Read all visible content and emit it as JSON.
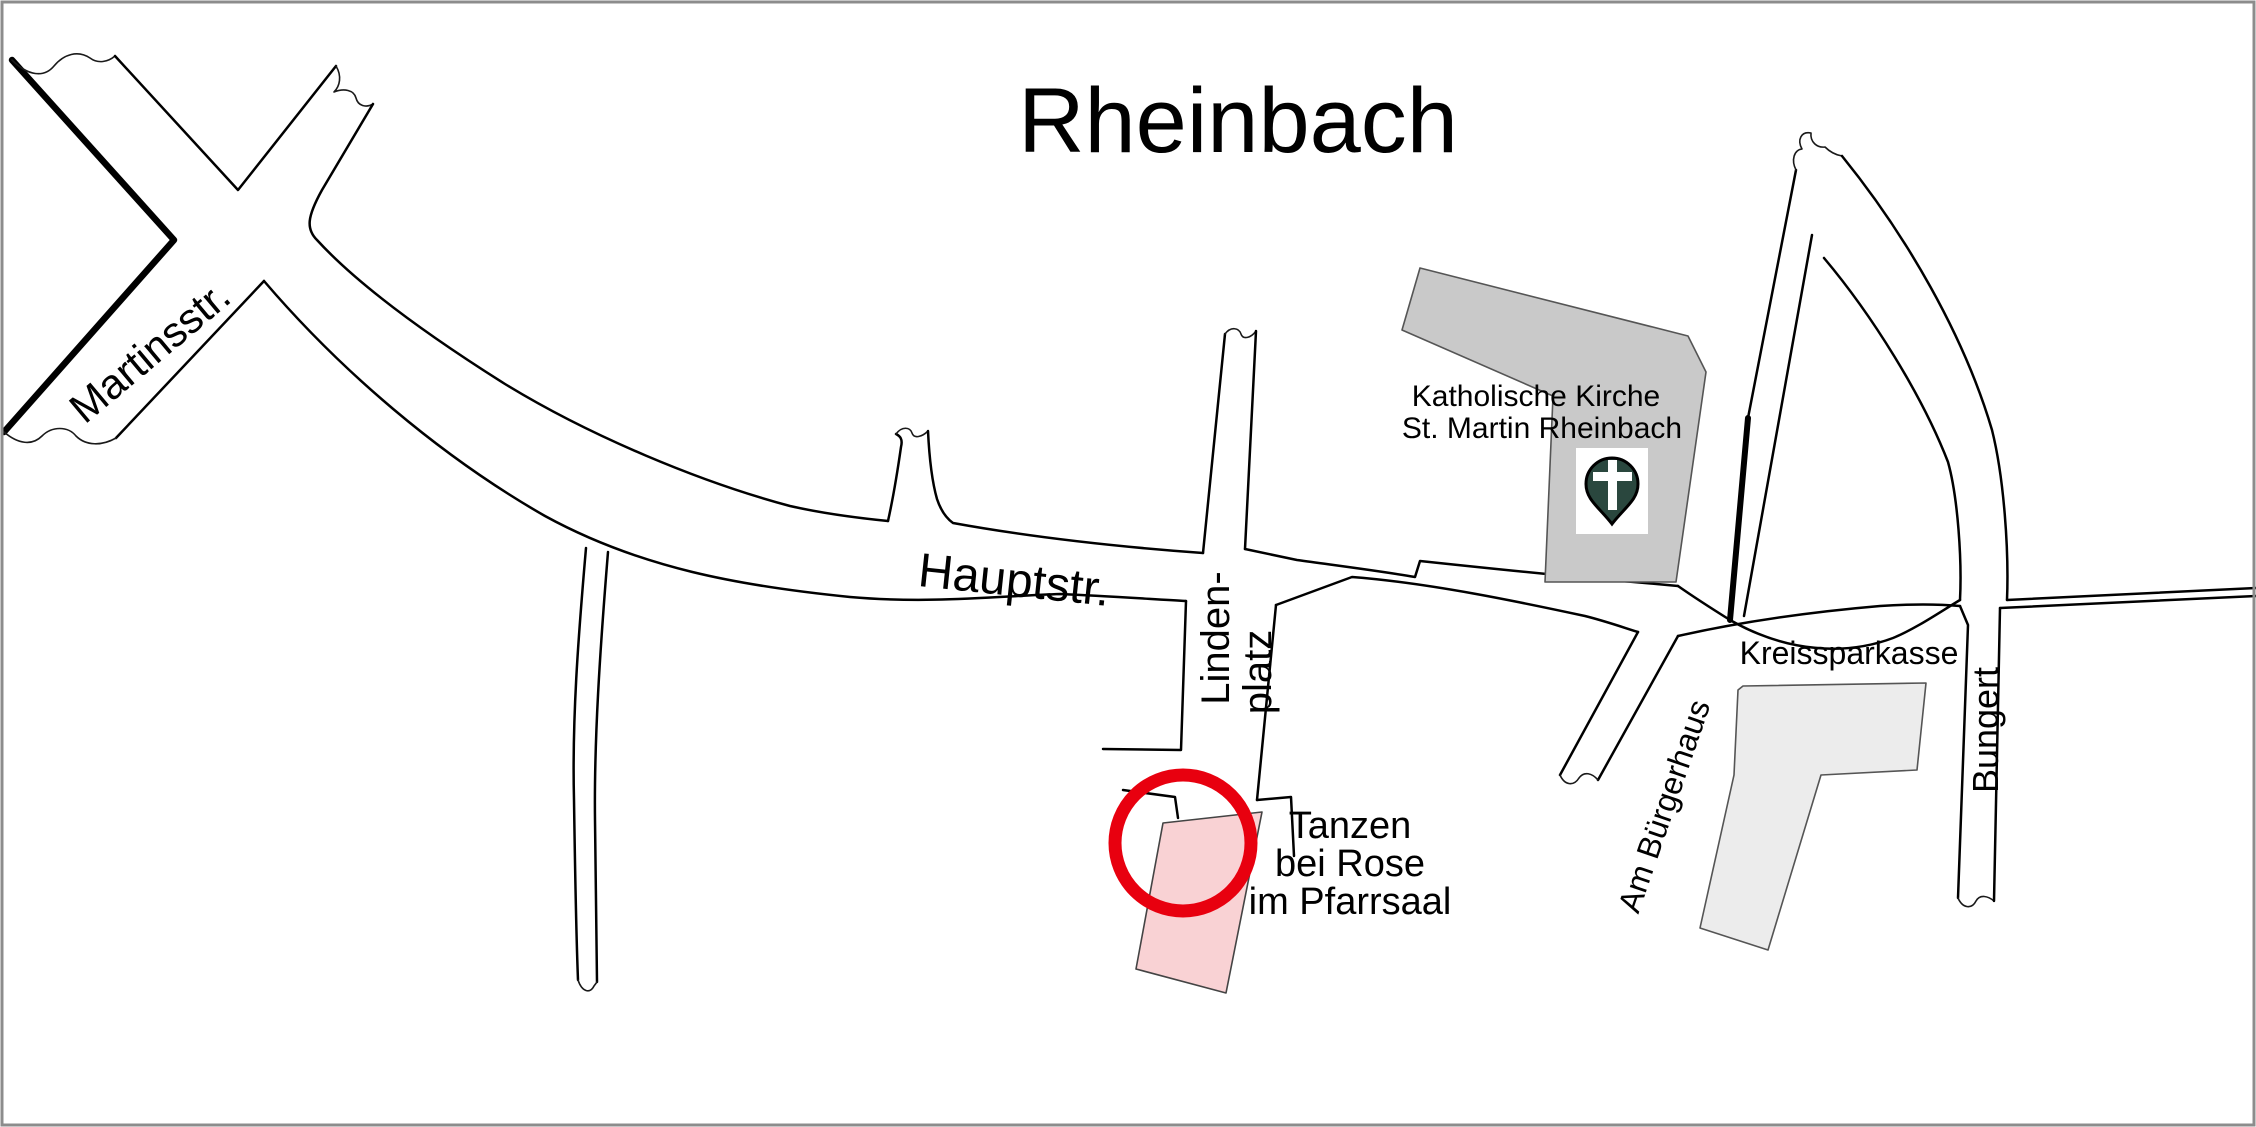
{
  "map": {
    "title": "Rheinbach",
    "streets": {
      "martinsstrasse": "Martinsstr.",
      "hauptstrasse": "Hauptstr.",
      "lindenplatz_line1": "Linden-",
      "lindenplatz_line2": "platz",
      "am_buergerhaus": "Am Bürgerhaus",
      "bungert": "Bungert"
    },
    "places": {
      "church_line1": "Katholische Kirche",
      "church_line2": "St. Martin Rheinbach",
      "bank": "Kreissparkasse"
    },
    "venue": {
      "line1": "Tanzen",
      "line2": "bei Rose",
      "line3": "im Pfarrsaal"
    },
    "icons": {
      "church_pin": "map-pin-with-cross"
    },
    "colors": {
      "background": "#ffffff",
      "frame": "#8c8c8c",
      "road_stroke": "#000000",
      "church_fill": "#c9c9c9",
      "bank_fill": "#ececec",
      "venue_fill": "#f9d2d4",
      "highlight_ring": "#e8000f",
      "pin_fill": "#2a473e",
      "pin_cross": "#ffffff"
    }
  }
}
